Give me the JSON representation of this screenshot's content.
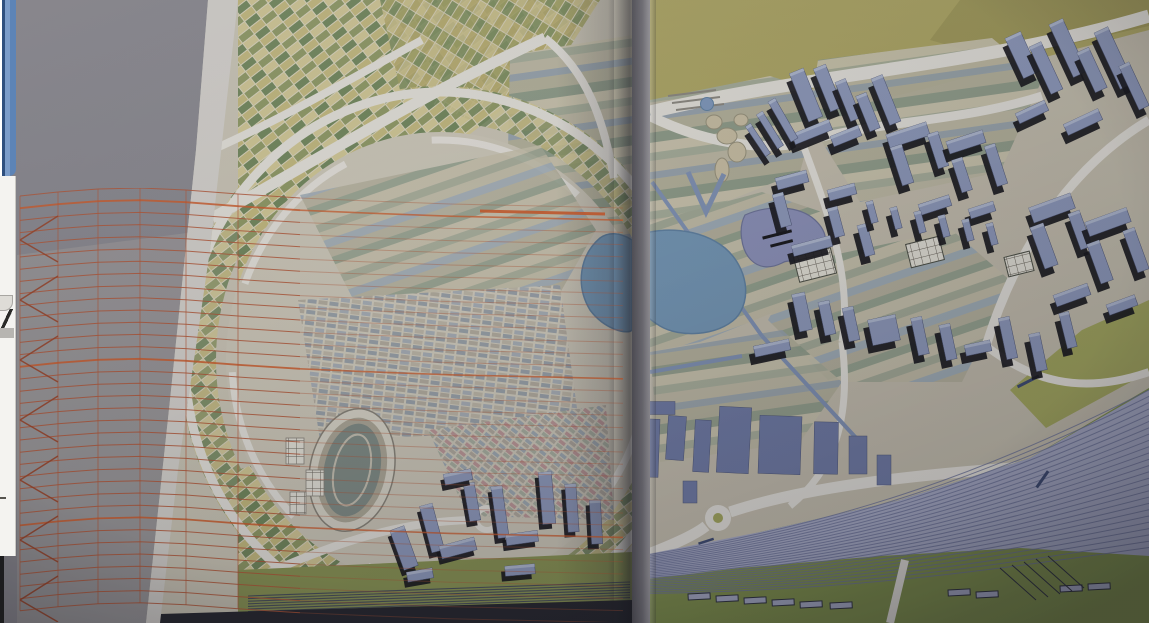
{
  "scene": {
    "description": "Photograph of an open book spread showing a coloured urban masterplan drawing; an orange perspective wireframe grid folds over the left page, and a sliver of a background application window is visible on the left screen edge",
    "left_page": "circular city plan with checkered farm fields, fine housing blocks, stadium, blue slab buildings and railway band",
    "right_page": "district of blue axonometric buildings, lake and purple pond, striped fields, roundabout road and fanning railway yard",
    "overlay": "orange accordion-fold perspective mesh"
  },
  "palette": {
    "backdrop": "#8b8992",
    "backdrop_light": "#a8a49f",
    "paper": "#cfc9b6",
    "paper_margin": "#d9d6d0",
    "paper_right": "#c9c2ae",
    "road": "#e9e6de",
    "olive": "#b3aa59",
    "olive_dark": "#a49c4e",
    "lake_blue": "#6f9ac0",
    "lake_edge": "#5a84ac",
    "pond_purple": "#8d93c4",
    "building_face": "#8e9cc6",
    "building_top": "#b0bcd9",
    "building_shadow": "#15151b",
    "footprint_blue": "#6e7cb0",
    "rail_bed": "#a8adce",
    "rail_line": "#6c74a2",
    "grass": "#7e9340",
    "grass_dark": "#8a9748",
    "mesh_orange": "#c4512a",
    "mesh_dark": "#a83d1c",
    "mesh_bright": "#e2571c",
    "avenue_blue": "#7f95bf",
    "outline_dark": "#2c3040",
    "bottom_dark": "#23252e",
    "ui_window_blue": "#6a8fc0",
    "ui_panel": "#f4f3f0",
    "ui_dark_edge": "#1c1c1e"
  },
  "left_edge_ui": {
    "items": [
      {
        "name": "background-window-border"
      },
      {
        "name": "background-panel"
      },
      {
        "name": "button-corner"
      },
      {
        "name": "pen-stroke-icon"
      },
      {
        "name": "tiny-dash"
      },
      {
        "name": "screen-dark-edge"
      }
    ]
  },
  "render": {
    "mesh": {
      "cols": [
        20,
        58,
        98,
        140,
        186,
        238,
        300,
        370,
        450,
        540,
        623
      ],
      "wob": [
        0,
        -4,
        -7,
        -8,
        -6,
        -2,
        2,
        5,
        8,
        10,
        12
      ],
      "yTop": 196,
      "rows": 35,
      "rowStep": 12.2,
      "brightRows": [
        1,
        14,
        27
      ],
      "chevronYs": [
        210,
        270,
        330,
        390,
        450,
        510,
        570
      ]
    },
    "railway_main": {
      "count": 26,
      "x": [
        640,
        850,
        1000,
        1149
      ],
      "yStart": [
        556,
        524,
        466,
        390
      ],
      "yStep": [
        1.5,
        2.7,
        4.1,
        6.3
      ]
    },
    "railway_left": {
      "count": 7,
      "x0": 248,
      "y0": 596,
      "x1": 630,
      "y1": 582,
      "step": 2.6
    },
    "buildings_axon": [
      [
        806,
        95,
        15,
        52,
        -22
      ],
      [
        828,
        88,
        13,
        46,
        -22
      ],
      [
        848,
        100,
        11,
        42,
        -22
      ],
      [
        812,
        132,
        40,
        11,
        -22
      ],
      [
        846,
        136,
        30,
        11,
        -22
      ],
      [
        868,
        112,
        11,
        38,
        -22
      ],
      [
        886,
        100,
        12,
        50,
        -22
      ],
      [
        783,
        120,
        8,
        46,
        -30
      ],
      [
        770,
        130,
        7,
        40,
        -32
      ],
      [
        758,
        140,
        6,
        36,
        -34
      ],
      [
        1022,
        55,
        17,
        44,
        -25
      ],
      [
        1046,
        68,
        13,
        52,
        -25
      ],
      [
        1068,
        48,
        15,
        58,
        -25
      ],
      [
        1092,
        70,
        13,
        44,
        -25
      ],
      [
        1114,
        58,
        15,
        62,
        -25
      ],
      [
        1134,
        86,
        11,
        48,
        -25
      ],
      [
        1083,
        122,
        38,
        12,
        -25
      ],
      [
        1032,
        112,
        32,
        11,
        -25
      ],
      [
        908,
        135,
        42,
        14,
        -18
      ],
      [
        902,
        165,
        12,
        40,
        -18
      ],
      [
        938,
        150,
        11,
        36,
        -18
      ],
      [
        966,
        142,
        38,
        13,
        -18
      ],
      [
        962,
        175,
        11,
        34,
        -18
      ],
      [
        996,
        165,
        11,
        42,
        -18
      ],
      [
        935,
        205,
        32,
        11,
        -18
      ],
      [
        982,
        210,
        26,
        10,
        -18
      ],
      [
        792,
        180,
        32,
        12,
        -15
      ],
      [
        782,
        210,
        11,
        34,
        -15
      ],
      [
        842,
        192,
        28,
        11,
        -15
      ],
      [
        836,
        222,
        10,
        30,
        -15
      ],
      [
        812,
        246,
        40,
        11,
        -15
      ],
      [
        866,
        240,
        10,
        32,
        -15
      ],
      [
        872,
        212,
        7,
        22,
        -15
      ],
      [
        896,
        218,
        7,
        22,
        -15
      ],
      [
        920,
        222,
        7,
        22,
        -15
      ],
      [
        944,
        226,
        7,
        22,
        -15
      ],
      [
        968,
        230,
        7,
        22,
        -15
      ],
      [
        992,
        234,
        7,
        22,
        -15
      ],
      [
        1052,
        208,
        44,
        16,
        -20
      ],
      [
        1044,
        246,
        14,
        44,
        -20
      ],
      [
        1080,
        230,
        12,
        38,
        -20
      ],
      [
        1108,
        222,
        44,
        15,
        -20
      ],
      [
        1100,
        262,
        13,
        42,
        -20
      ],
      [
        1136,
        250,
        12,
        44,
        -20
      ],
      [
        1072,
        295,
        36,
        12,
        -20
      ],
      [
        1122,
        305,
        30,
        11,
        -20
      ],
      [
        802,
        312,
        13,
        38,
        -12
      ],
      [
        827,
        318,
        11,
        34,
        -12
      ],
      [
        851,
        324,
        11,
        34,
        -12
      ],
      [
        884,
        330,
        28,
        26,
        -12
      ],
      [
        920,
        336,
        11,
        38,
        -12
      ],
      [
        948,
        342,
        11,
        36,
        -12
      ],
      [
        978,
        348,
        26,
        11,
        -12
      ],
      [
        1008,
        338,
        11,
        42,
        -12
      ],
      [
        1038,
        352,
        11,
        38,
        -12
      ],
      [
        772,
        348,
        36,
        11,
        -12
      ],
      [
        1068,
        330,
        10,
        36,
        -14
      ]
    ],
    "buildings_flat": [
      [
        648,
        448,
        22,
        58,
        2
      ],
      [
        676,
        438,
        18,
        44,
        4
      ],
      [
        702,
        446,
        16,
        52,
        3
      ],
      [
        734,
        440,
        32,
        66,
        3
      ],
      [
        780,
        445,
        42,
        58,
        2
      ],
      [
        826,
        448,
        24,
        52,
        1
      ],
      [
        858,
        455,
        18,
        38,
        0
      ],
      [
        690,
        492,
        14,
        22,
        0
      ],
      [
        662,
        408,
        26,
        13,
        0
      ],
      [
        884,
        470,
        14,
        30,
        0
      ]
    ],
    "slabs_left": [
      [
        404,
        548,
        15,
        42,
        -20
      ],
      [
        432,
        528,
        13,
        48,
        -15
      ],
      [
        458,
        548,
        36,
        13,
        -15
      ],
      [
        472,
        502,
        11,
        38,
        -10
      ],
      [
        500,
        512,
        11,
        52,
        -8
      ],
      [
        522,
        538,
        32,
        11,
        -8
      ],
      [
        547,
        498,
        13,
        52,
        -5
      ],
      [
        572,
        508,
        11,
        48,
        -4
      ],
      [
        596,
        522,
        11,
        44,
        -3
      ],
      [
        458,
        477,
        28,
        11,
        -12
      ],
      [
        420,
        575,
        26,
        10,
        -10
      ],
      [
        520,
        570,
        30,
        10,
        -5
      ]
    ],
    "sheds_bottom": [
      [
        688,
        594
      ],
      [
        716,
        596
      ],
      [
        744,
        598
      ],
      [
        772,
        600
      ],
      [
        800,
        602
      ],
      [
        830,
        603
      ],
      [
        948,
        590
      ],
      [
        976,
        592
      ],
      [
        1060,
        586
      ],
      [
        1088,
        584
      ]
    ]
  }
}
